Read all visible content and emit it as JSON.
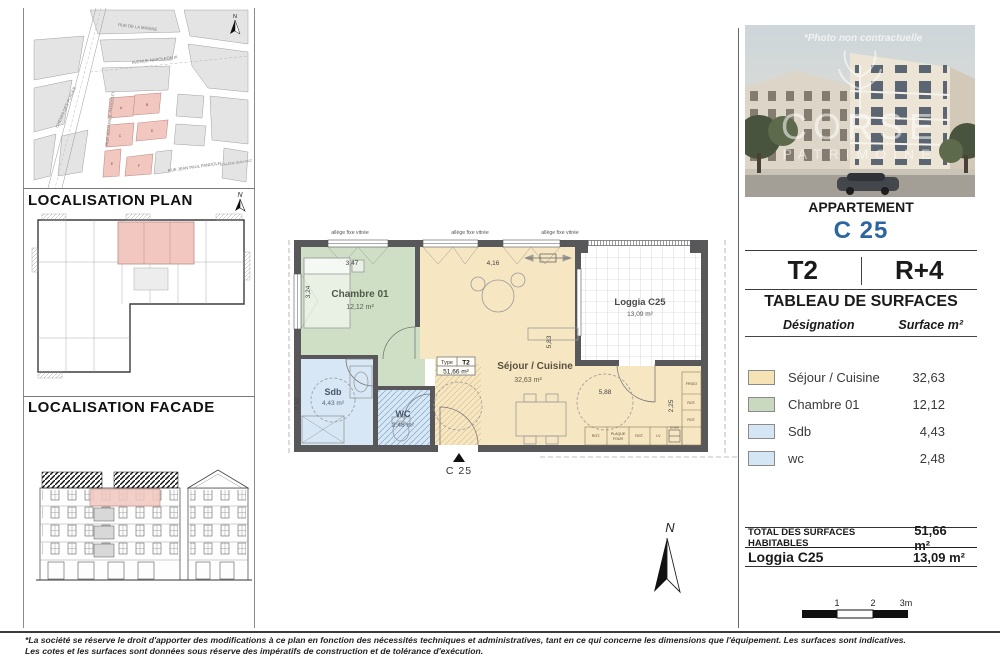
{
  "north": "N",
  "titles": {
    "plan": "LOCALISATION PLAN",
    "facade": "LOCALISATION FACADE"
  },
  "colors": {
    "accent_blue": "#2b66a0",
    "highlight_pink": "#f1c7bf",
    "wall_gray": "#58585a"
  },
  "map": {
    "streets": {
      "marine": "RUE DE LA MARINE",
      "napoleon": "AVENUE NAPOLEON III",
      "pandolfi_left": "RUE JEAN PAUL PANDOLFI",
      "pandolfi_bottom": "RUE JEAN PAUL PANDOLFI",
      "plages": "CHEMIN DES PLAGES"
    },
    "college": "COLLEGE JEAN NICOLI",
    "buildings": [
      "A",
      "B",
      "C",
      "D",
      "E",
      "F"
    ]
  },
  "photo": {
    "caption": "*Photo non contractuelle",
    "brand_top": "CORSE",
    "brand_bottom": "PATRIMOINE"
  },
  "apartment": {
    "header": "APPARTEMENT",
    "unit": "C 25",
    "type": "T2",
    "floor": "R+4"
  },
  "surfaces": {
    "title": "TABLEAU DE SURFACES",
    "col_label": "Désignation",
    "col_value": "Surface m²",
    "rows": [
      {
        "label": "Séjour / Cuisine",
        "value": "32,63",
        "color": "#f6e3b5"
      },
      {
        "label": "Chambre 01",
        "value": "12,12",
        "color": "#c9d9c0"
      },
      {
        "label": "Sdb",
        "value": "4,43",
        "color": "#d4e5f4"
      },
      {
        "label": "wc",
        "value": "2,48",
        "color": "#d4e5f4"
      }
    ],
    "total_label": "TOTAL DES SURFACES HABITABLES",
    "total_value": "51,66 m²",
    "loggia_label": "Loggia C25",
    "loggia_value": "13,09 m²"
  },
  "plan": {
    "allege": "allège fixe vitrée",
    "entrance": "C 25",
    "rooms": {
      "chambre": {
        "name": "Chambre 01",
        "area": "12,12 m²",
        "color": "#cfdfc6"
      },
      "sejour": {
        "name": "Séjour / Cuisine",
        "area": "32,63 m²",
        "color": "#f6e6c2"
      },
      "loggia": {
        "name": "Loggia C25",
        "area": "13,09 m²"
      },
      "sdb": {
        "name": "Sdb",
        "area": "4,43 m²",
        "color": "#d7e7f5"
      },
      "wc": {
        "name": "WC",
        "area": "2,48 m²",
        "color": "#d7e7f5"
      }
    },
    "type_box": {
      "label": "Type",
      "value": "T2",
      "area": "51,66 m²"
    },
    "dims": {
      "chambre_w": "3,47",
      "chambre_h": "3,24",
      "sejour_w": "4,16",
      "sejour_h": "5,83",
      "kitchen_w": "5,88",
      "kitchen_h": "2,25",
      "sdb_h": "2,52"
    },
    "kitchen": {
      "frigo": "FRIGO",
      "rgt": "RGT.",
      "plaque_1": "PLAQUE",
      "plaque_2": "FOUR",
      "lv": "LV",
      "evier": "EVIER"
    }
  },
  "scalebar": {
    "t1": "1",
    "t2": "2",
    "t3": "3m"
  },
  "footer": {
    "line1": "*La société se réserve le droit d'apporter des modifications à ce plan en fonction des nécessités techniques et administratives, tant en ce qui concerne les dimensions que l'équipement. Les surfaces sont indicatives.",
    "line2": "Les cotes et les surfaces sont données sous réserve des impératifs de construction et de tolérance d'exécution."
  }
}
